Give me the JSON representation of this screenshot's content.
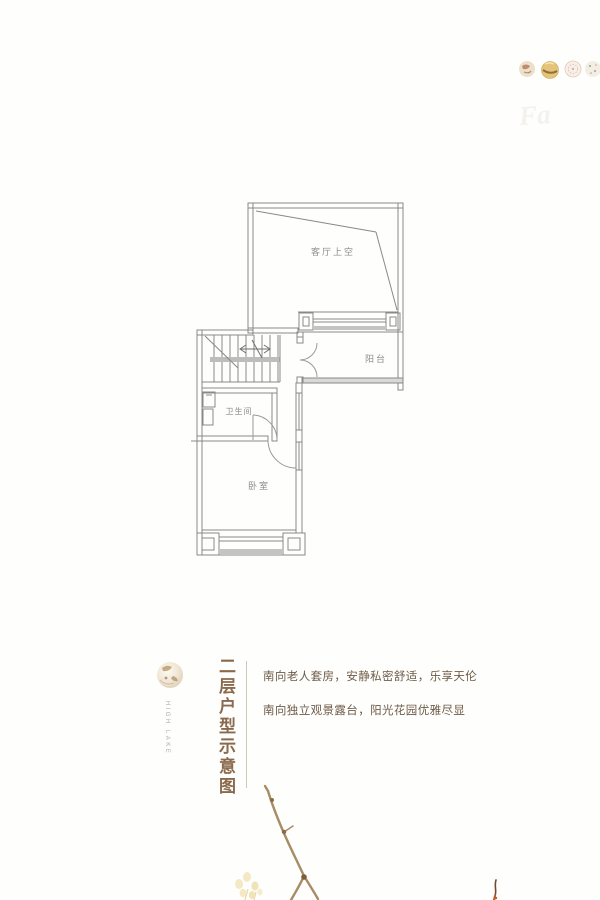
{
  "page": {
    "background": "#fefefd",
    "description": "Second-floor residential floor-plan marketing page"
  },
  "floor_plan": {
    "rooms": [
      {
        "id": "living-void",
        "label": "客厅上空"
      },
      {
        "id": "balcony",
        "label": "阳台"
      },
      {
        "id": "bathroom",
        "label": "卫生间"
      },
      {
        "id": "bedroom",
        "label": "卧室"
      }
    ],
    "features": [
      "staircase",
      "french-door-to-balcony",
      "bedroom-door",
      "bathroom-door",
      "window-bands"
    ]
  },
  "caption": {
    "vertical_title": "二层户型示意图",
    "brand_vertical_text": "HIGH LAKE",
    "lines": [
      "南向老人套房，安静私密舒适，乐享天伦",
      "南向独立观景露台，阳光花园优雅尽显"
    ]
  },
  "decorations": {
    "watermark_text": "Fa",
    "logo": "gold-brand-medallion",
    "medallions": [
      "gold-seal-1",
      "gold-seal-2",
      "pale-ring-seal",
      "speckled-seal"
    ],
    "branch": "dried-branch-sketch",
    "flowers": "pale-yellow-blossoms",
    "red_twig": "small-red-twig"
  },
  "colors": {
    "wall_line": "#898989",
    "thick_fill": "#c2c2c2",
    "title_brown": "#8a6a4c",
    "text_brown": "#6e5b47",
    "branch_gold": "#a78c66",
    "flower_yellow": "#f2e4b4",
    "twig_red": "#c2592b"
  }
}
